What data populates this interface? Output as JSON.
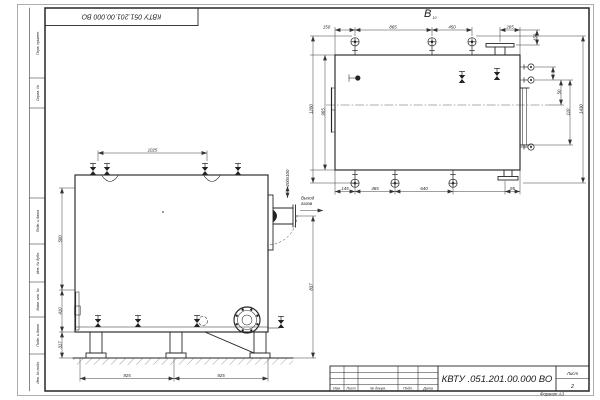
{
  "sheet": {
    "stamp_top": "КВТУ 051.201.00.000 ВО",
    "side_strips": [
      "Перв. примен.",
      "Справ. №",
      "Подп. и дата",
      "Инв. № дубл.",
      "Взам. инв. №",
      "Подп. и дата",
      "Инв. № подл."
    ],
    "title_block": {
      "columns": [
        "Изм.",
        "Лист",
        "№ докум.",
        "Подп.",
        "Дата"
      ],
      "doc_number": "КВТУ .051.201.00.000  ВО",
      "sheet_label": "Лист",
      "sheet_number": "2",
      "format_note": "Формат А3"
    }
  },
  "top_view": {
    "label": "В",
    "label_sub": "10",
    "dims_top": [
      "150",
      "865",
      "450",
      "265"
    ],
    "dim_right_top": "150",
    "dims_bottom": [
      "145",
      "465",
      "640",
      "95"
    ],
    "dims_left": [
      "1260",
      "965"
    ],
    "dims_right": [
      "50",
      "110",
      "1430"
    ]
  },
  "front_view": {
    "dim_top": "1025",
    "dims_left": [
      "500",
      "410",
      "317"
    ],
    "dim_right": "837",
    "dims_bottom": [
      "925",
      "925"
    ],
    "flue_size": "200x100",
    "outlet_label": [
      "Выход",
      "газов"
    ]
  }
}
